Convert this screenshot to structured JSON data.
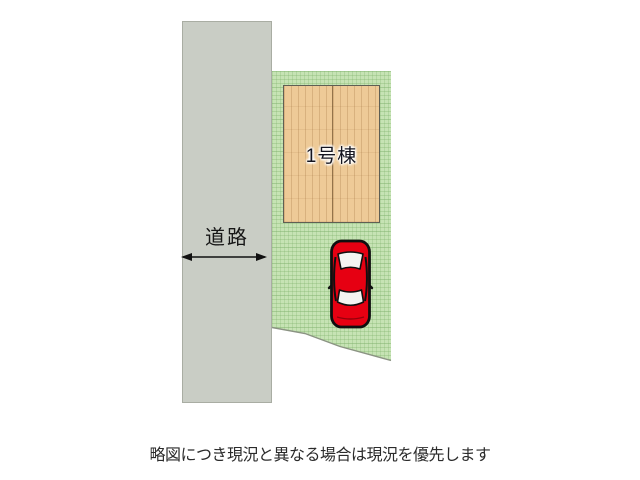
{
  "figure": {
    "road": {
      "label": "道路"
    },
    "building": {
      "label": "1号棟"
    },
    "icons": {
      "road_width_arrow": "double-headed-arrow",
      "car": "red-car-top-view"
    },
    "colors": {
      "road_fill": "#c9cdc5",
      "grass_fill": "#c6e3b4",
      "grass_grid": "#7aae66",
      "wood_fill": "#eeca97",
      "building_border": "#5f5f54",
      "car_red": "#e60012",
      "car_outline": "#101010",
      "arrow": "#111111",
      "caption_text": "#2b2b2b"
    }
  },
  "caption": {
    "text": "略図につき現況と異なる場合は現況を優先します"
  }
}
